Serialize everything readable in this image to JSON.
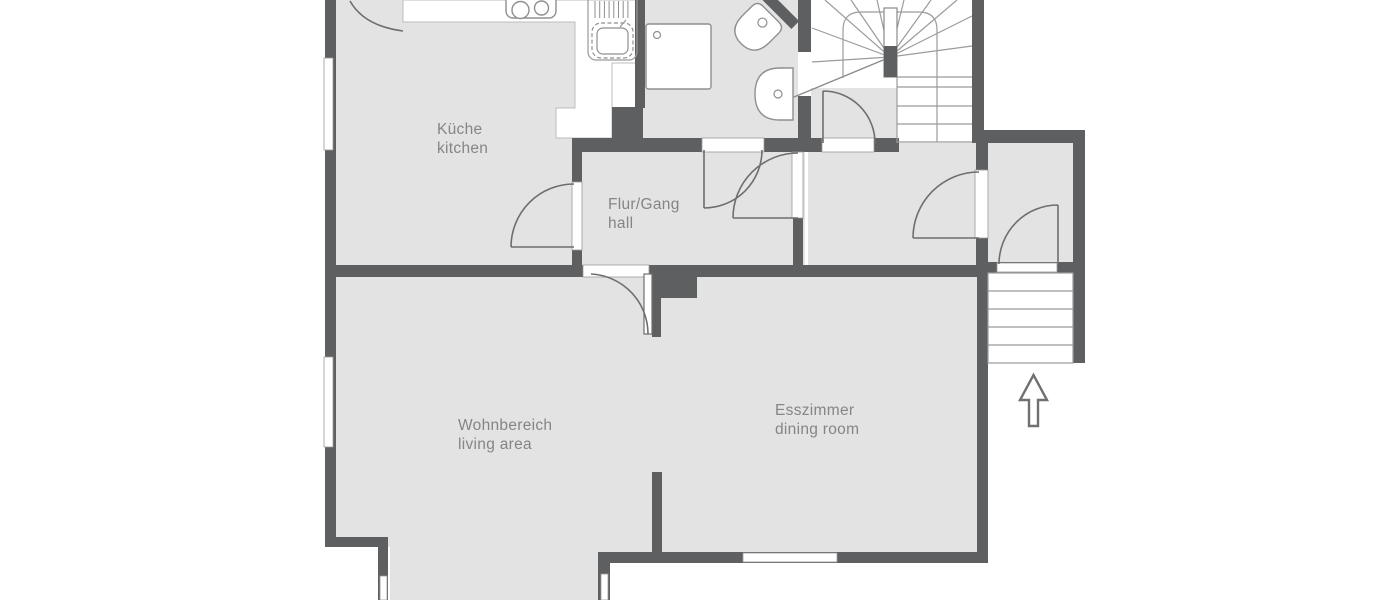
{
  "plan": {
    "type": "floor-plan",
    "rooms": {
      "kitchen": {
        "name_de": "Küche",
        "name_en": "kitchen"
      },
      "hall": {
        "name_de": "Flur/Gang",
        "name_en": "hall"
      },
      "living": {
        "name_de": "Wohnbereich",
        "name_en": "living area"
      },
      "dining": {
        "name_de": "Esszimmer",
        "name_en": "dining room"
      }
    },
    "colors": {
      "wall": "#5e5f61",
      "floor": "#e3e3e4",
      "fixture_outline": "#8f8f90",
      "stair_line": "#9b9b9b",
      "label": "#858585",
      "background": "#ffffff"
    }
  }
}
